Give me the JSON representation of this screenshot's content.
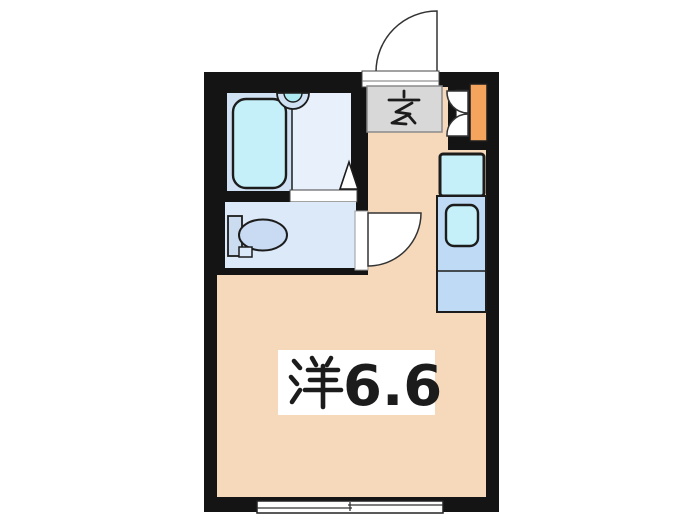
{
  "plan": {
    "type": "apartment-floor-plan",
    "labels": {
      "entrance": "玄",
      "room": "洋6.6",
      "room_kanji": "洋",
      "room_area": "6.6"
    },
    "fixtures": [
      "bathtub",
      "bath-sink",
      "bathroom-door-triangle",
      "toilet-tank",
      "toilet-bowl",
      "kitchen-stove",
      "kitchen-counter",
      "kitchen-sink",
      "shoe-cabinet",
      "closet-double-doors",
      "entrance-door",
      "toilet-door",
      "sliding-window"
    ]
  },
  "colors": {
    "bg": "#ffffff",
    "wall": "#141414",
    "line": "#1c1c1c",
    "floor-main": "#f6d9ba",
    "floor-bath": "#cfe1f3",
    "floor-wash": "#e8f1fb",
    "floor-toilet": "#dce9f8",
    "fixture-cyan": "#c5f0f9",
    "sink-inner": "#aeeaf2",
    "counter-blue": "#bedaf4",
    "tank-blue": "#ccdcf0",
    "cabinet-orange": "#f4a45c",
    "genkan-gray": "#d8d8d8"
  }
}
